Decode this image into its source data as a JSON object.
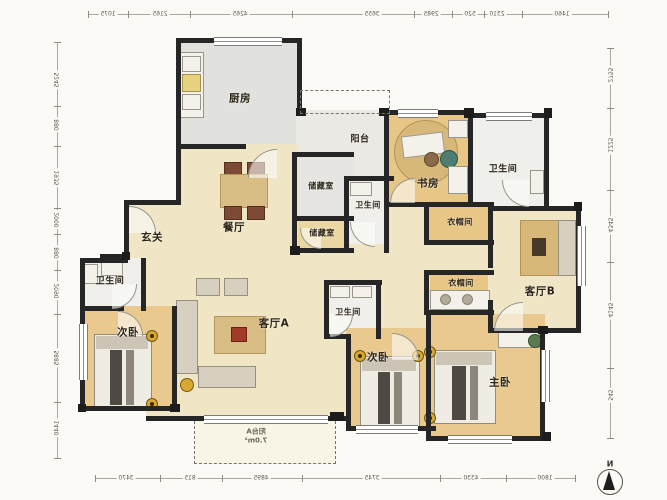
{
  "plan": {
    "title": "apartment-floor-plan",
    "rooms": {
      "kitchen": {
        "label": "厨房"
      },
      "balcony_top": {
        "label": "阳台"
      },
      "storage_1": {
        "label": "储藏室"
      },
      "bath_mid": {
        "label": "卫生间"
      },
      "storage_2": {
        "label": "储藏室"
      },
      "study": {
        "label": "书房"
      },
      "bath_top_right": {
        "label": "卫生间"
      },
      "cloak_1": {
        "label": "衣帽间"
      },
      "living_b": {
        "label": "客厅B"
      },
      "cloak_2": {
        "label": "衣帽间"
      },
      "entry": {
        "label": "玄关"
      },
      "dining": {
        "label": "餐厅"
      },
      "living_a": {
        "label": "客厅A"
      },
      "bath_left": {
        "label": "卫生间"
      },
      "bedroom_left": {
        "label": "次卧"
      },
      "bath_center": {
        "label": "卫生间"
      },
      "bedroom_mid": {
        "label": "次卧"
      },
      "master": {
        "label": "主卧"
      },
      "balcony_a": {
        "label": "阳台A",
        "area": "7.0m²"
      }
    },
    "compass": {
      "label": "N"
    },
    "dimensions": {
      "top": [
        "1075",
        "2165",
        "4265",
        "3655",
        "2985",
        "520",
        "2310",
        "1460"
      ],
      "bottom": [
        "3470",
        "815",
        "4895",
        "3745",
        "4330",
        "1800"
      ],
      "left": [
        "5245",
        "880",
        "1935",
        "2000",
        "880",
        "2090",
        "5885",
        "1440"
      ],
      "right": [
        "2755",
        "1225",
        "4345",
        "4145",
        "545"
      ]
    },
    "colors": {
      "wall": "#262626",
      "floor_warm": "#e9c98e",
      "floor_cream": "#f0e6c6",
      "floor_gray": "#e2e2df",
      "floor_white": "#f0efeb",
      "accent_gold": "#d9a832"
    }
  }
}
